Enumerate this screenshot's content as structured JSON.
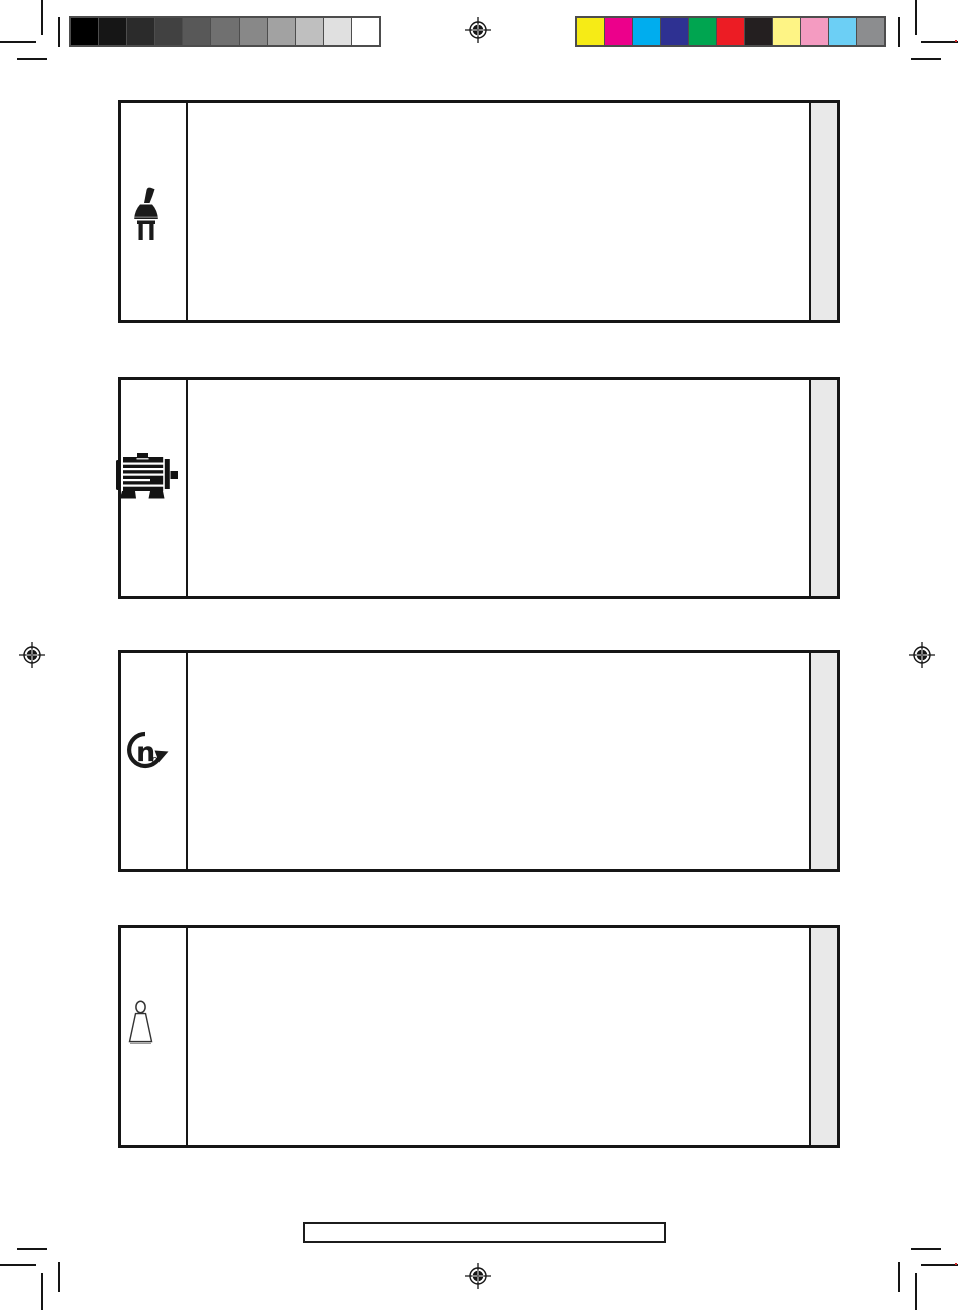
{
  "page": {
    "kind": "scanned-manual-symbol-page",
    "background": "#ffffff"
  },
  "print_marks": {
    "registration_marks": [
      "top-center",
      "left-middle",
      "right-middle",
      "bottom-center"
    ],
    "corner_crop_marks": [
      "top-left",
      "top-right",
      "bottom-left",
      "bottom-right"
    ],
    "grayscale_bar": {
      "border_color": "#4d4d4d",
      "swatches": [
        "#000000",
        "#161616",
        "#2b2b2b",
        "#414141",
        "#585858",
        "#707070",
        "#888888",
        "#a2a2a2",
        "#bfbfbf",
        "#e0e0e0",
        "#ffffff"
      ]
    },
    "color_bar": {
      "border_color": "#4d4d4d",
      "swatches": [
        "#f6eb16",
        "#ec008b",
        "#00adee",
        "#2e3192",
        "#00a550",
        "#ec1c24",
        "#241f20",
        "#fef485",
        "#f49bc1",
        "#6ccff5",
        "#8c8d8f"
      ]
    }
  },
  "symbol_table": {
    "border_color": "#161616",
    "side_strip_color": "#e9e9e9",
    "rows": [
      {
        "icon": "power-plug-icon",
        "content": ""
      },
      {
        "icon": "electric-motor-icon",
        "content": ""
      },
      {
        "icon": "no-load-speed-icon",
        "symbol_main": "n",
        "symbol_sub": "0",
        "content": ""
      },
      {
        "icon": "weight-icon",
        "content": ""
      }
    ]
  },
  "footer": {
    "note_box_content": ""
  }
}
